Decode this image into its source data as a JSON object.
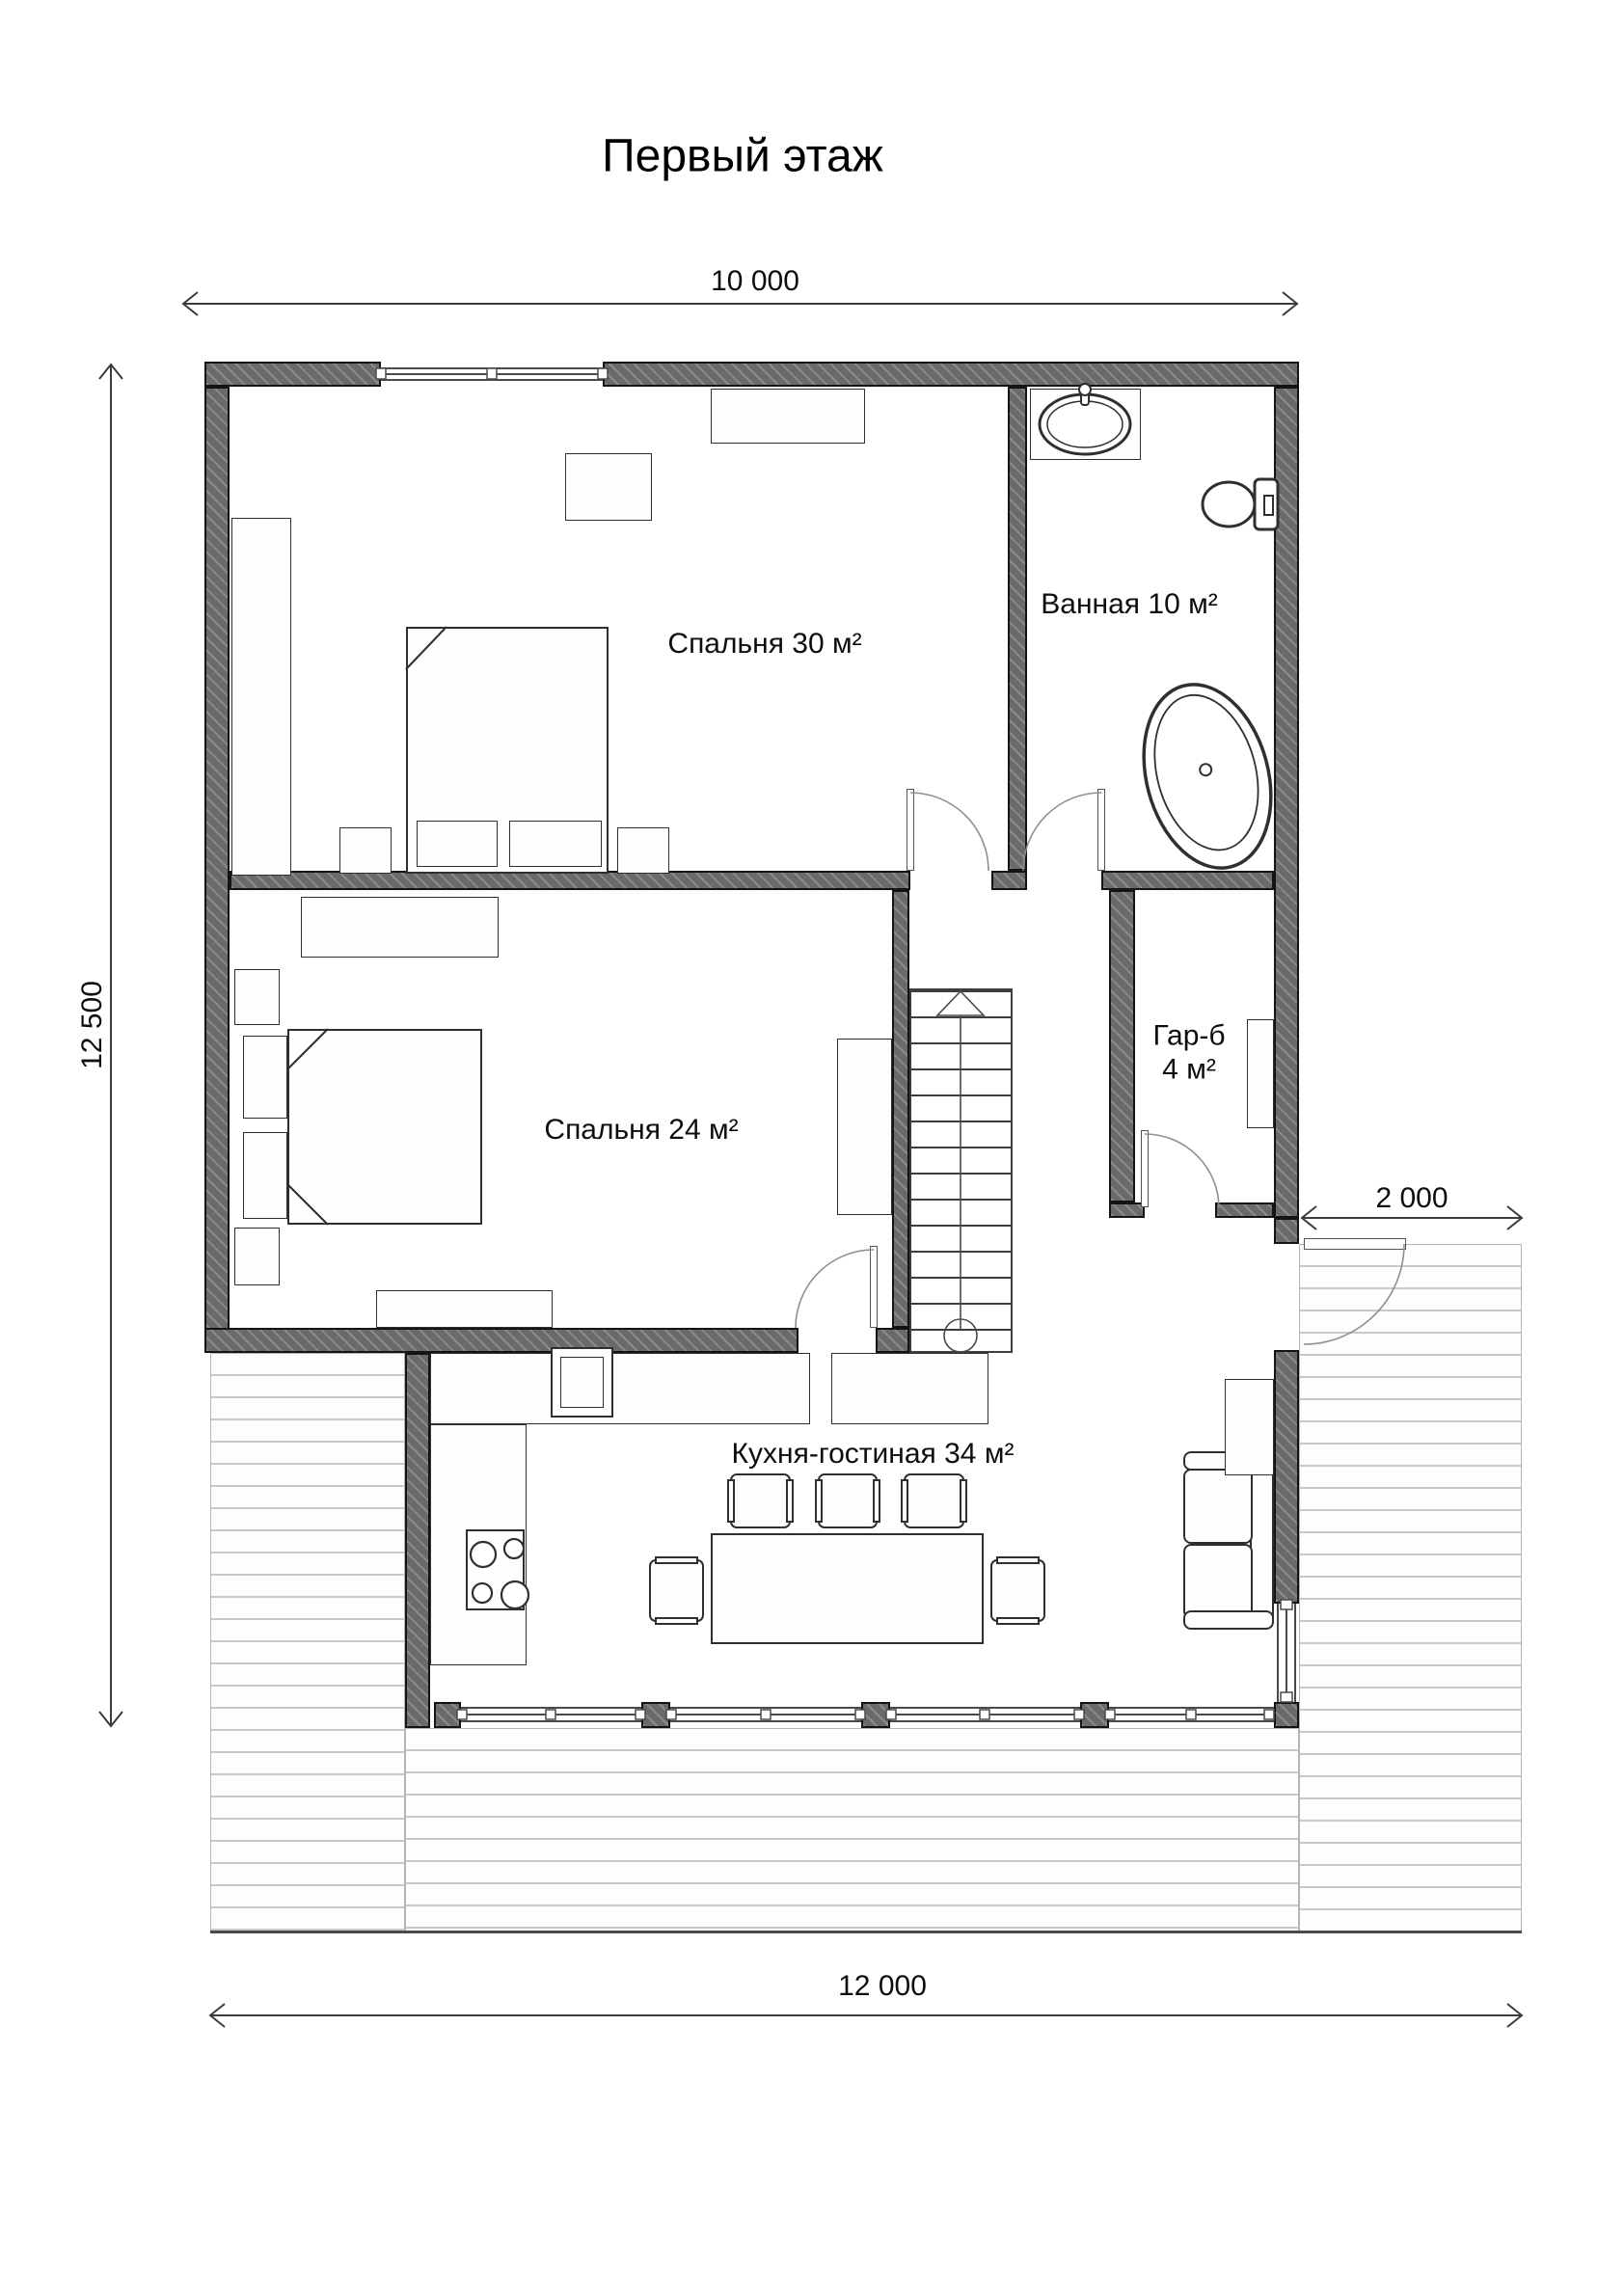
{
  "title": "Первый этаж",
  "dimensions": {
    "top": "10 000",
    "left": "12 500",
    "right": "2 000",
    "bottom": "12 000"
  },
  "rooms": {
    "bedroom30": {
      "label": "Спальня 30 м²"
    },
    "bathroom": {
      "label": "Ванная 10 м²"
    },
    "bedroom24": {
      "label": "Спальня 24 м²"
    },
    "wardrobe": {
      "label": "Гар-б",
      "area": "4 м²"
    },
    "kitchen": {
      "label": "Кухня-гостиная 34 м²"
    }
  },
  "colors": {
    "wall": "#6a6a6a",
    "outline": "#2f2f2f",
    "deck_line": "#c9c9c9",
    "dimension_line": "#3c3c3c",
    "text": "#0d0d0d"
  }
}
